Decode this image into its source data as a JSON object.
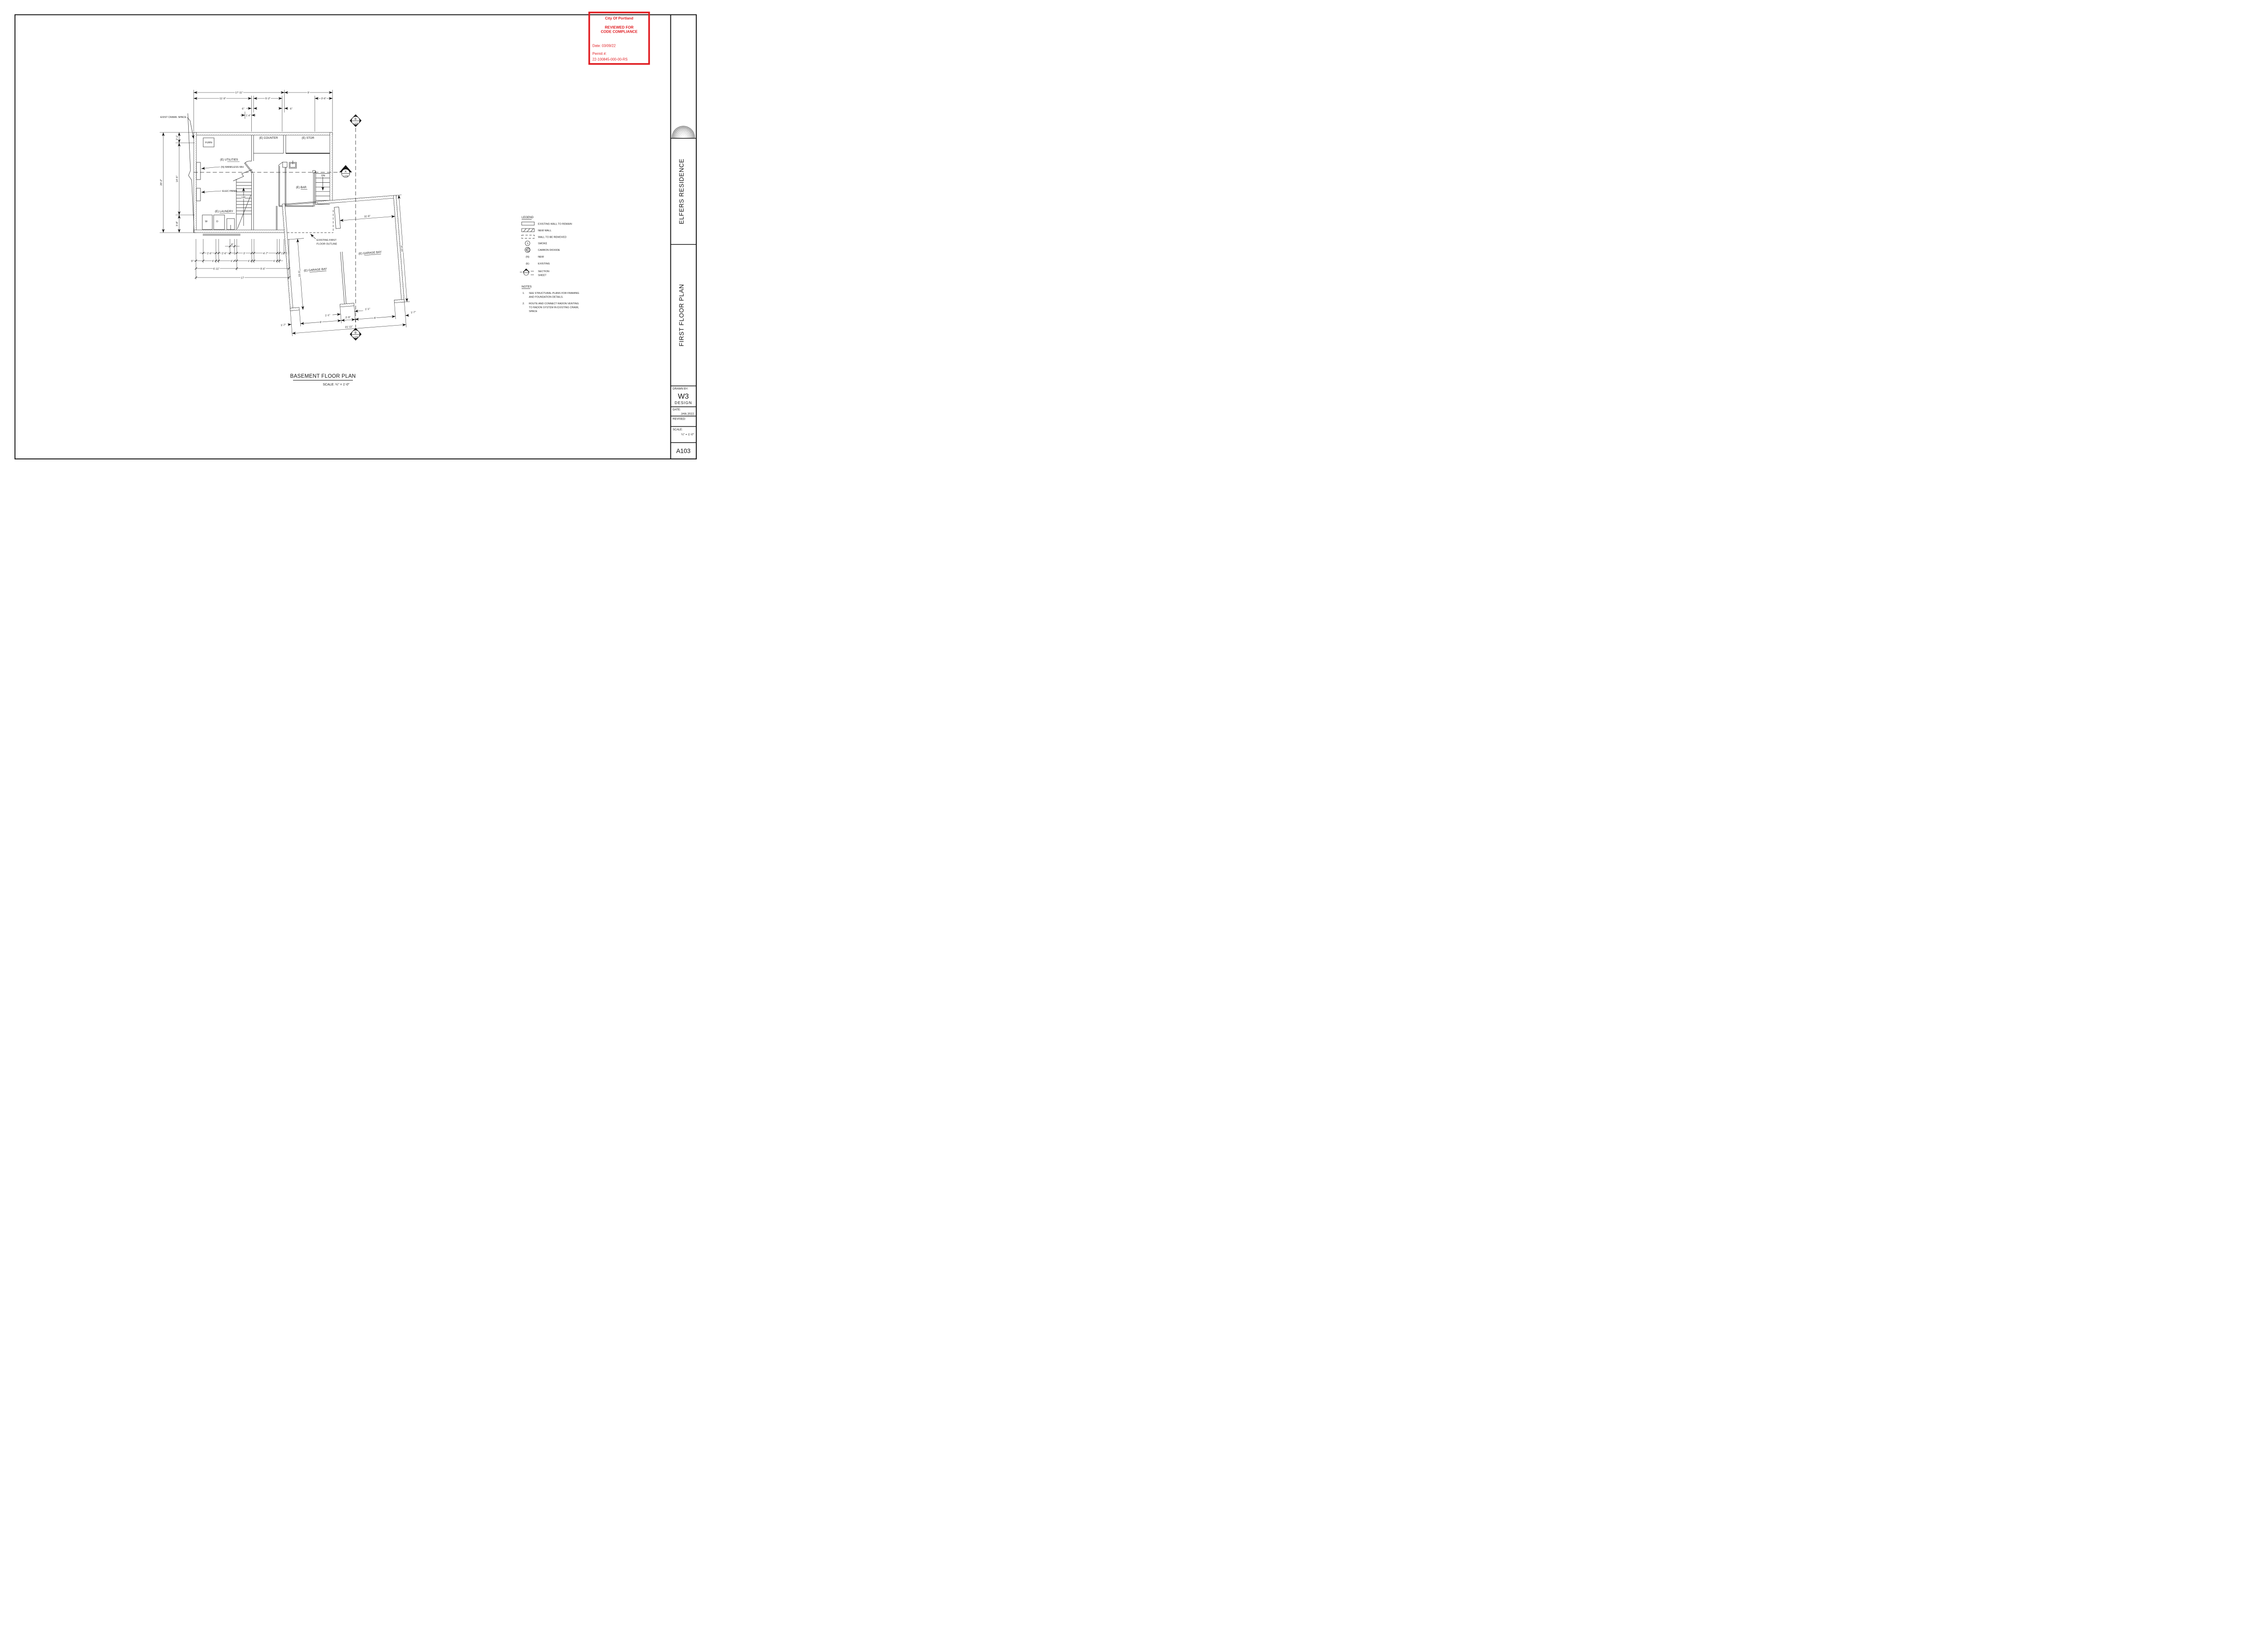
{
  "stamp": {
    "line1": "City Of Portland",
    "line2": "REVIEWED FOR",
    "line3": "CODE COMPLIANCE",
    "date": "Date: 03/09/22",
    "permit_label": "Permit #:",
    "permit_number": "22-100845-000-00-RS",
    "color": "#e01b20"
  },
  "title_block": {
    "project": "ELFERS RESIDENCE",
    "sheet_title": "FIRST FLOOR PLAN",
    "drawn_by_label": "DRAWN BY:",
    "drawn_by_name": "W3",
    "drawn_by_sub": "DESIGN",
    "date_label": "DATE:",
    "date_value": "JAN 2022",
    "revised_label": "REVISED:",
    "scale_label": "SCALE:",
    "scale_value": "¼\" = 1'-0\"",
    "sheet_number": "A103"
  },
  "legend": {
    "title": "LEGEND",
    "existing_wall": "EXISTING WALL TO REMAIN",
    "new_wall": "NEW WALL",
    "removed_wall": "WALL TO BE REMOVED",
    "smoke_sym": "S",
    "smoke": "SMOKE",
    "co_sym": "CO",
    "co": "CARBON DIOXIDE",
    "new_sym": "(N)",
    "new": "NEW",
    "existing_sym": "(E)",
    "existing": "EXISTING",
    "section": "SECTION",
    "sheet": "SHEET"
  },
  "notes": {
    "title": "NOTES",
    "n1_num": "1.",
    "n1_l1": "SEE STRUCTURAL PLANS FOR FRAMING",
    "n1_l2": "AND FOUNDATION DETAILS.",
    "n2_num": "2.",
    "n2_l1": "ROUTE AND CONNECT RADON VENTING",
    "n2_l2": "TO RADON SYSTEM IN EXISTING CRAWL",
    "n2_l3": "SPACE"
  },
  "plan": {
    "title": "BASEMENT FLOOR PLAN",
    "scale": "SCALE: ¼\" = 1'-0\"",
    "labels": {
      "crawl": "EXIST CRAWL SPACE",
      "furn": "FURN",
      "counter": "(E) COUNTER",
      "stor": "(E) STOR",
      "utilities": "(E) UTILITIES",
      "tankless": "(N) RANKLESS WH",
      "elec": "ELEC PANEL",
      "laundry": "(E) LAUNDRY",
      "washer": "W",
      "dryer": "D",
      "up": "UP",
      "dn": "DN",
      "bar": "(E) BAR",
      "garage_bay": "(E) GARAGE BAY",
      "outline1": "EXISTING FIRST",
      "outline2": "FLOOR OUTLINE"
    },
    "markers": {
      "a": "A",
      "b": "B",
      "ref_sheet": "A106"
    },
    "dims": {
      "t1711": "17'-11\"",
      "t9": "9'",
      "t119": "11'-9\"",
      "t52": "5'-2\"",
      "t36": "3'-6\"",
      "d6": "6\"",
      "t14": "1'-4\"",
      "l202": "20'-2\"",
      "l21": "2'-1\"",
      "l145": "14'-5\"",
      "l38": "3'-8\"",
      "b8in": "8\"",
      "b26": "2'-6\"",
      "b3": "3'",
      "b47": "4'-7\"",
      "b1": "1'",
      "b9in": "9\"",
      "b611": "6'-11\"",
      "b96": "9'-6\"",
      "b17": "17'",
      "g116": "11'-6\"",
      "g200": "20'-0\"",
      "g155": "15'-5\"",
      "g11": "1'-1\"",
      "g17": "1'-7\"",
      "g8": "8'",
      "g29": "2'-9\"",
      "g2111": "21'-11\""
    }
  }
}
